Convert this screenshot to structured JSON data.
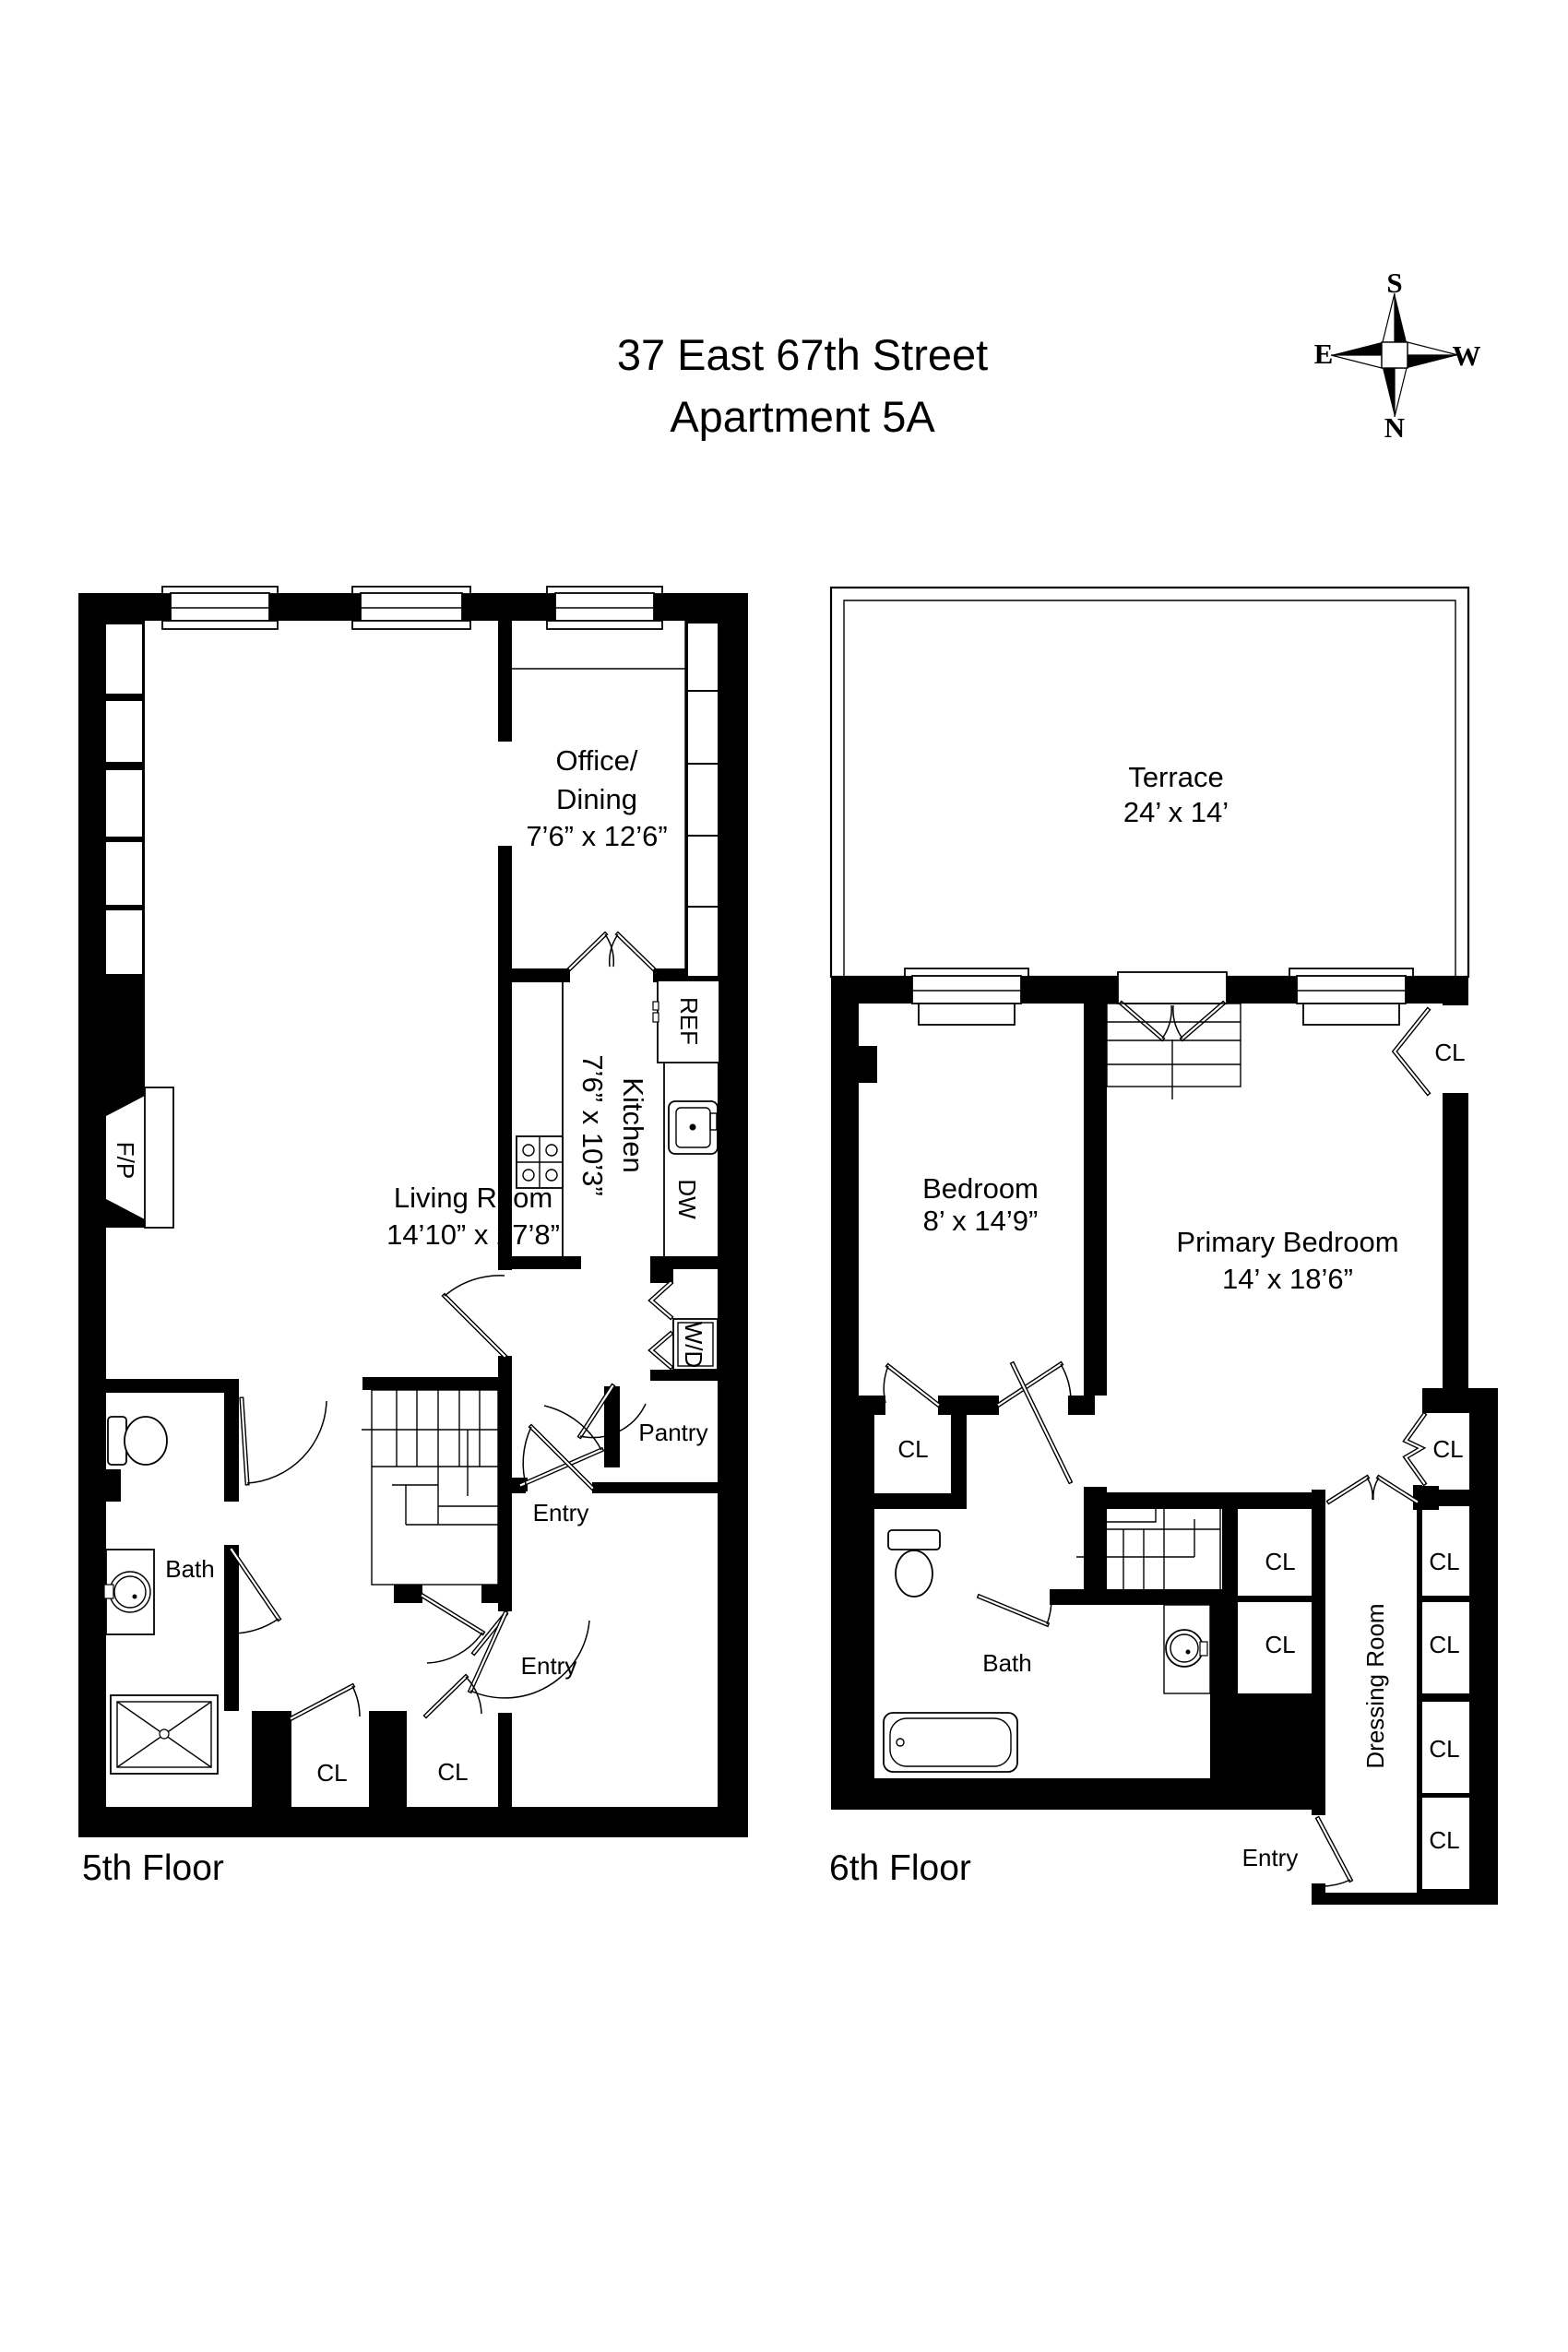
{
  "title": {
    "line1": "37 East 67th Street",
    "line2": "Apartment 5A"
  },
  "compass": {
    "top": "S",
    "bottom": "N",
    "left": "E",
    "right": "W"
  },
  "floor5": {
    "label": "5th Floor",
    "living": {
      "name": "Living Room",
      "dims": "14’10” x 27’8”"
    },
    "office": {
      "name_line1": "Office/",
      "name_line2": "Dining",
      "dims": "7’6” x 12’6”"
    },
    "kitchen": {
      "name": "Kitchen",
      "dims": "7’6” x 10’3”"
    },
    "bath": {
      "name": "Bath"
    },
    "pantry": {
      "name": "Pantry"
    },
    "entry_upper": "Entry",
    "entry_lower": "Entry",
    "closet1": "CL",
    "closet2": "CL",
    "fireplace": "F/P",
    "fridge": "REF",
    "dishwasher": "DW",
    "washer_dryer": "W/D"
  },
  "floor6": {
    "label": "6th Floor",
    "terrace": {
      "name": "Terrace",
      "dims": "24’ x 14’"
    },
    "bedroom": {
      "name": "Bedroom",
      "dims": "8’ x 14’9”"
    },
    "primary": {
      "name": "Primary Bedroom",
      "dims": "14’ x 18’6”"
    },
    "bath": {
      "name": "Bath"
    },
    "dressing": {
      "name": "Dressing Room"
    },
    "entry": "Entry",
    "closet_top_right": "CL",
    "closet_left": "CL",
    "closet_right_upper": "CL",
    "closet_mid_upper": "CL",
    "closet_mid_lower": "CL",
    "closet_stack1": "CL",
    "closet_stack2": "CL",
    "closet_stack3": "CL",
    "closet_stack4": "CL"
  }
}
